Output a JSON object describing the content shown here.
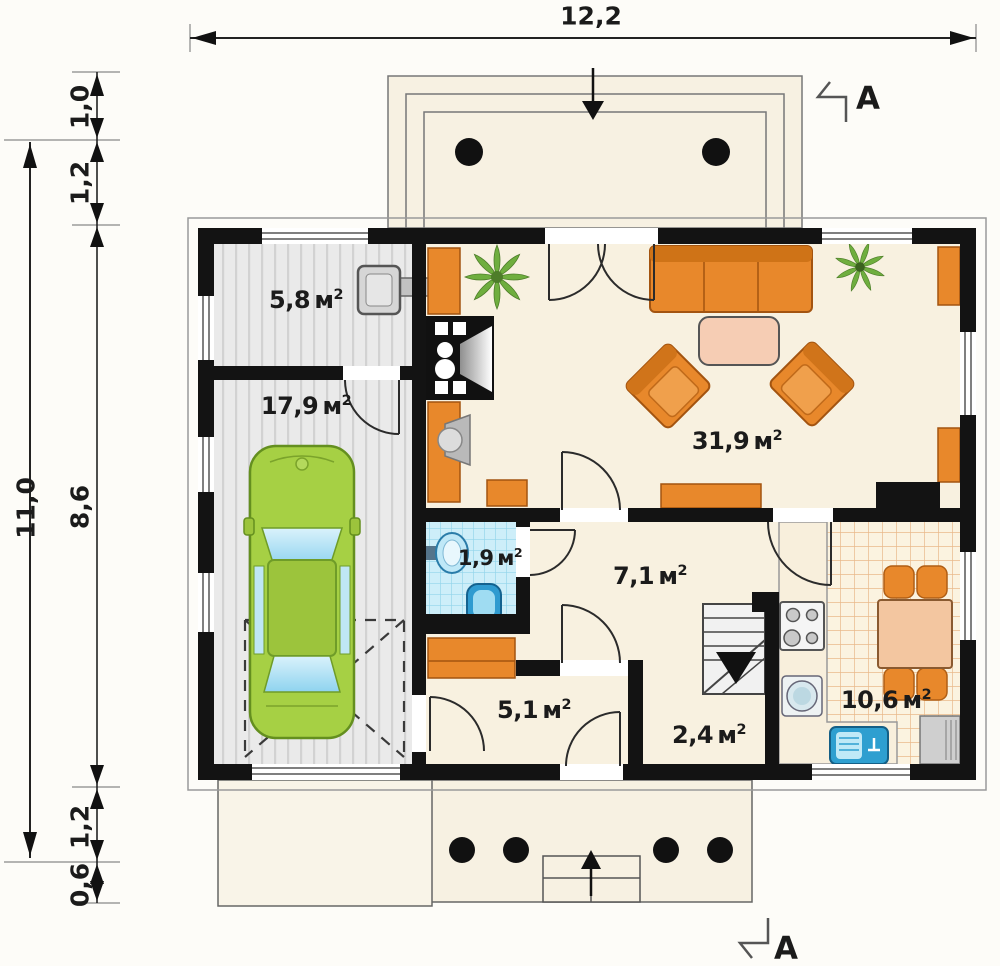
{
  "dimensions": {
    "total_width": "12,2",
    "total_height": "11,0",
    "left_segments": [
      "1,0",
      "1,2",
      "8,6",
      "1,2",
      "0,6"
    ]
  },
  "section": {
    "label": "A"
  },
  "area_unit": {
    "unit": "м",
    "sup": "2"
  },
  "rooms": [
    {
      "name": "utility-room",
      "area": "5,8"
    },
    {
      "name": "garage",
      "area": "17,9"
    },
    {
      "name": "living-room",
      "area": "31,9"
    },
    {
      "name": "bathroom",
      "area": "1,9"
    },
    {
      "name": "hall",
      "area": "7,1"
    },
    {
      "name": "vestibule",
      "area": "5,1"
    },
    {
      "name": "stair-hall",
      "area": "2,4"
    },
    {
      "name": "kitchen",
      "area": "10,6"
    }
  ],
  "colors": {
    "wall": "#131313",
    "floor_cream": "#f8f1e0",
    "garage_floor": "#eaeaea",
    "bath_tile": "#cdeef9",
    "kitchen_grid_line": "#e9b98a",
    "furniture_orange": "#e8882b",
    "car_green": "#a6d044",
    "fixture_blue": "#35a3d4"
  }
}
